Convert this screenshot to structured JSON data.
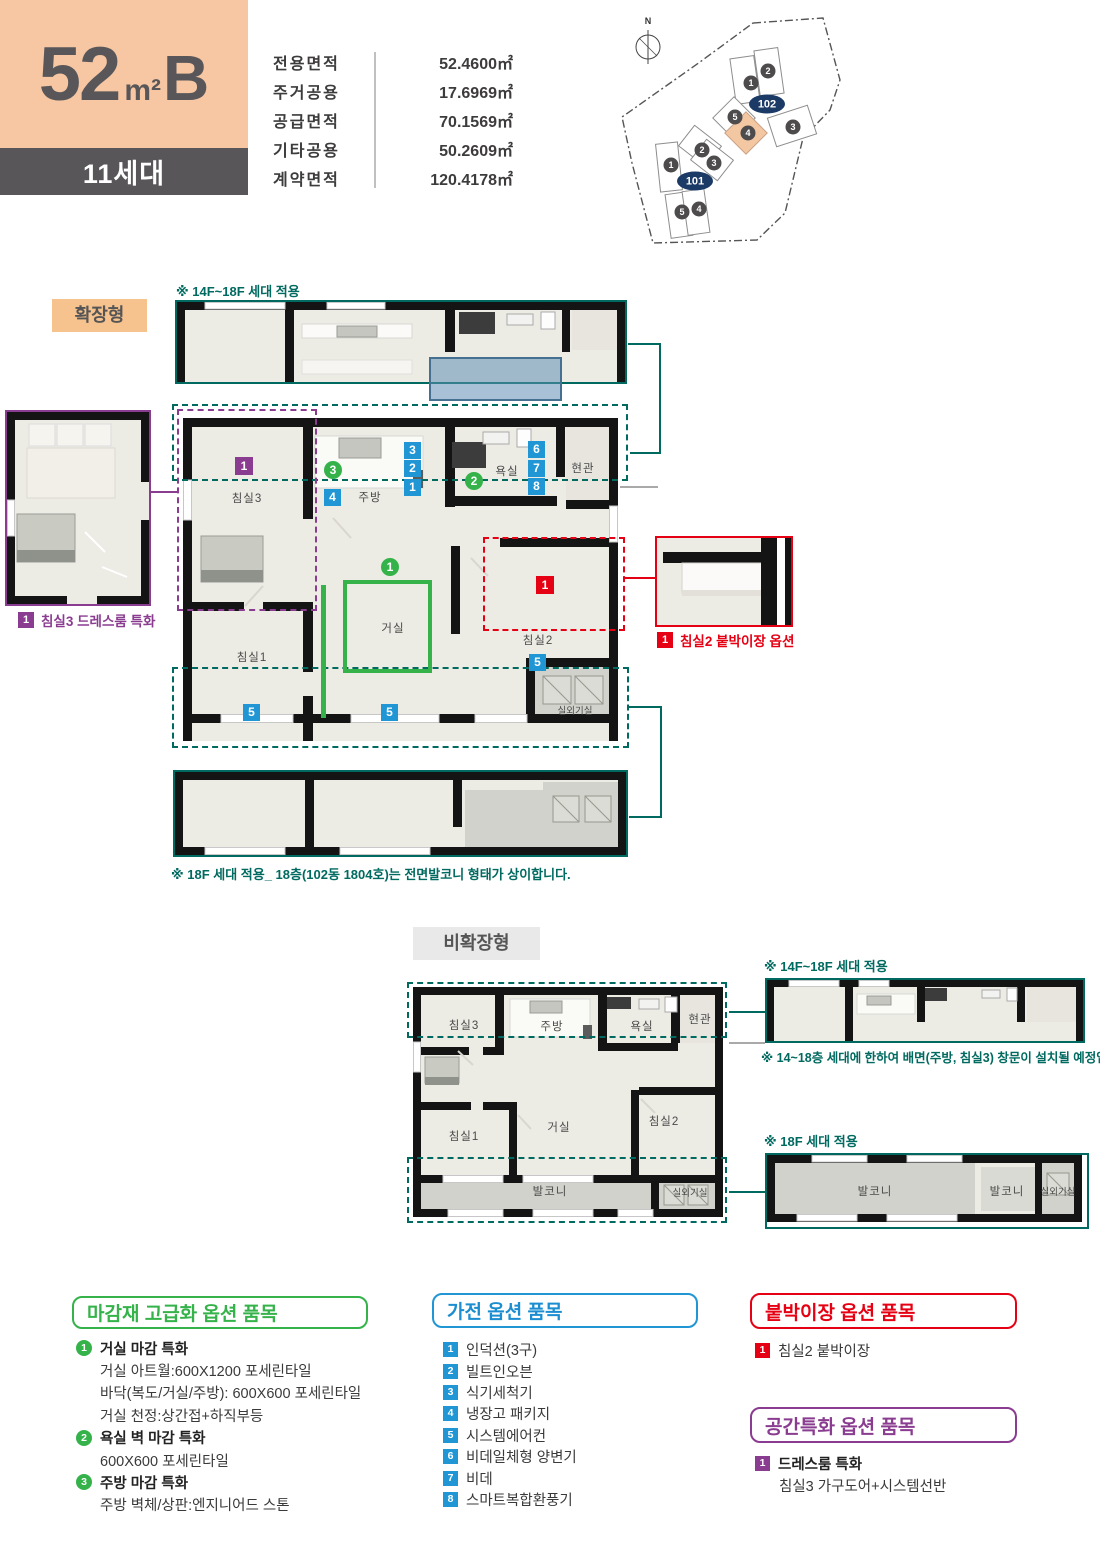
{
  "nums": [
    "1",
    "2",
    "3",
    "4",
    "5",
    "6",
    "7",
    "8"
  ],
  "header": {
    "unit_number": "52",
    "unit_unit": "m²",
    "unit_letter": "B",
    "households": "11세대",
    "area_rows": [
      {
        "label": "전용면적",
        "value": "52.4600㎡"
      },
      {
        "label": "주거공용",
        "value": "17.6969㎡"
      },
      {
        "label": "공급면적",
        "value": "70.1569㎡"
      },
      {
        "label": "기타공용",
        "value": "50.2609㎡"
      },
      {
        "label": "계약면적",
        "value": "120.4178㎡"
      }
    ]
  },
  "site": {
    "north": "N",
    "oval101": "101",
    "oval102": "102",
    "c1": "1",
    "c2": "2",
    "c3": "3",
    "c4": "4",
    "c5": "5"
  },
  "expanded": {
    "label": "확장형",
    "note14": "※ 14F~18F 세대 적용",
    "footnote": "※ 18F 세대 적용_ 18층(102동 1804호)는 전면발코니 형태가 상이합니다.",
    "rooms": {
      "bed3": "침실3",
      "bed1": "침실1",
      "bed2": "침실2",
      "living": "거실",
      "kitchen": "주방",
      "bath": "욕실",
      "entry": "현관",
      "ac": "실외기실"
    },
    "callout_bed3": "침실3 드레스룸 특화",
    "callout_bed2": "침실2 붙박이장 옵션"
  },
  "nonexpanded": {
    "label": "비확장형",
    "note14": "※ 14F~18F 세대 적용",
    "note18": "※ 18F 세대 적용",
    "note_window": "※ 14~18층 세대에 한하여 배면(주방, 침실3) 창문이 설치될 예정입니다.",
    "rooms": {
      "bed3": "침실3",
      "bed1": "침실1",
      "bed2": "침실2",
      "living": "거실",
      "kitchen": "주방",
      "bath": "욕실",
      "entry": "현관",
      "ac": "실외기실",
      "balcony": "발코니"
    },
    "strip18": {
      "balcony_l": "발코니",
      "balcony_r": "발코니",
      "ac": "실외기실"
    }
  },
  "options": {
    "finish": {
      "title": "마감재 고급화 옵션 품목",
      "groups": [
        {
          "num": "1",
          "title": "거실 마감 특화",
          "lines": [
            "거실 아트월:600X1200 포세린타일",
            "바닥(복도/거실/주방): 600X600 포세린타일",
            "거실 천정:상간접+하직부등"
          ]
        },
        {
          "num": "2",
          "title": "욕실 벽 마감 특화",
          "lines": [
            "600X600 포세린타일"
          ]
        },
        {
          "num": "3",
          "title": "주방 마감 특화",
          "lines": [
            "주방 벽체/상판:엔지니어드 스톤"
          ]
        }
      ]
    },
    "appliance": {
      "title": "가전 옵션 품목",
      "items": [
        {
          "num": "1",
          "label": "인덕션(3구)"
        },
        {
          "num": "2",
          "label": "빌트인오븐"
        },
        {
          "num": "3",
          "label": "식기세척기"
        },
        {
          "num": "4",
          "label": "냉장고 패키지"
        },
        {
          "num": "5",
          "label": "시스템에어컨"
        },
        {
          "num": "6",
          "label": "비데일체형 양변기"
        },
        {
          "num": "7",
          "label": "비데"
        },
        {
          "num": "8",
          "label": "스마트복합환풍기"
        }
      ]
    },
    "closet": {
      "title": "붙박이장 옵션 품목",
      "num": "1",
      "item": "침실2 붙박이장"
    },
    "space": {
      "title": "공간특화 옵션 품목",
      "num": "1",
      "item_title": "드레스룸 특화",
      "item_line": "침실3 가구도어+시스템선반"
    }
  },
  "colors": {
    "teal": "#006a60",
    "purple": "#8a3c90",
    "red": "#e60013",
    "blue": "#2196d5",
    "green": "#35b34a",
    "peach": "#f6c7a2",
    "darkgray": "#595659"
  }
}
